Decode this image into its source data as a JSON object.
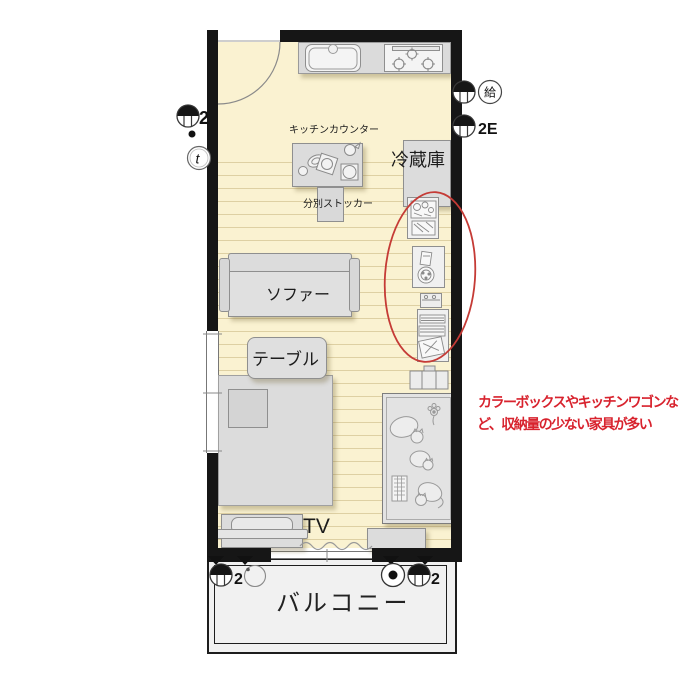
{
  "plan": {
    "type": "floor-plan",
    "floor_color": "#FAF2D1",
    "wall_color": "#161616",
    "highlight_color": "#C53B36"
  },
  "labels": {
    "kitchen_counter_top": "キッチンカウンター",
    "fridge": "冷蔵庫",
    "waste_stocker": "分別ストッカー",
    "sofa": "ソファー",
    "table": "テーブル",
    "tv": "TV",
    "balcony": "バルコニー"
  },
  "symbols": {
    "left_wall_light_count": "2",
    "left_wall_t": "t",
    "right_wall_supply": "給",
    "right_wall_outlet": "2E",
    "balcony_left_count": "2",
    "balcony_right_count": "2"
  },
  "annotation": {
    "text_line1": "カラーボックスやキッチンワゴンな",
    "text_line2": "ど、収納量の少ない家具が多い",
    "color": "#D8232E"
  }
}
